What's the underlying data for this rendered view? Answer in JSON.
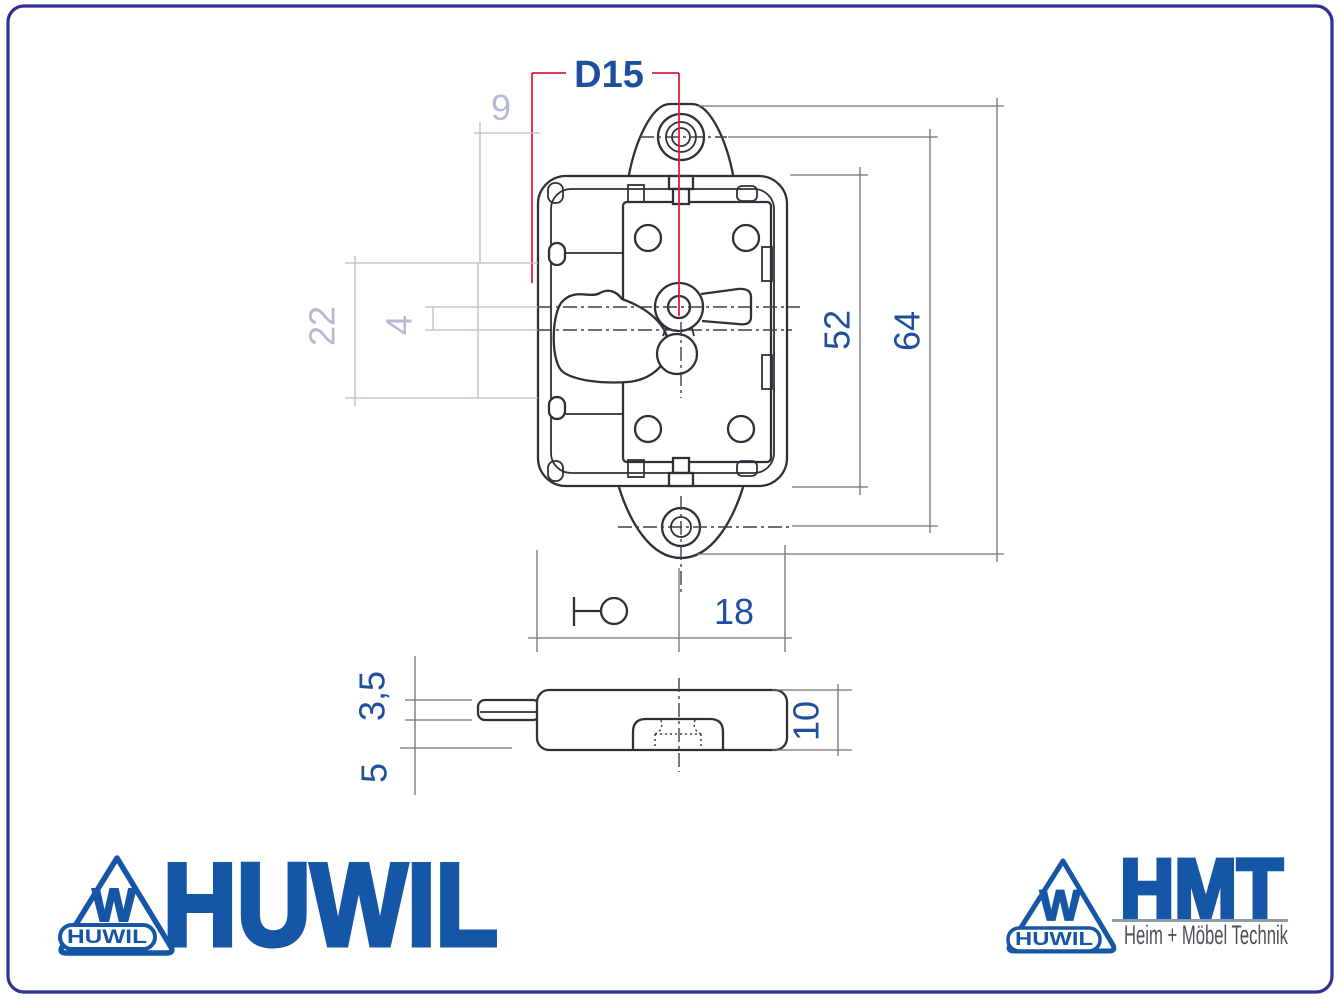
{
  "frame": {
    "border_color": "#2e3192"
  },
  "dimensions": {
    "d15": "D15",
    "nine": "9",
    "twenty_two": "22",
    "four": "4",
    "fifty_two": "52",
    "sixty_four": "64",
    "eighteen": "18",
    "three_five": "3,5",
    "five": "5",
    "ten": "10"
  },
  "colors": {
    "dimension_dark_blue": "#1d4f9f",
    "dimension_light_gray": "#b3bad4",
    "dimension_red": "#e31c3f",
    "logo_blue": "#1557a6",
    "tagline_gray": "#4c5157"
  },
  "logos": {
    "huwil": {
      "wordmark": "HUWIL",
      "triangle_letter": "W",
      "triangle_banner": "HUWIL"
    },
    "hmt": {
      "wordmark": "HMT",
      "tagline": "Heim + Möbel Technik",
      "triangle_letter": "W",
      "triangle_banner": "HUWIL"
    }
  }
}
